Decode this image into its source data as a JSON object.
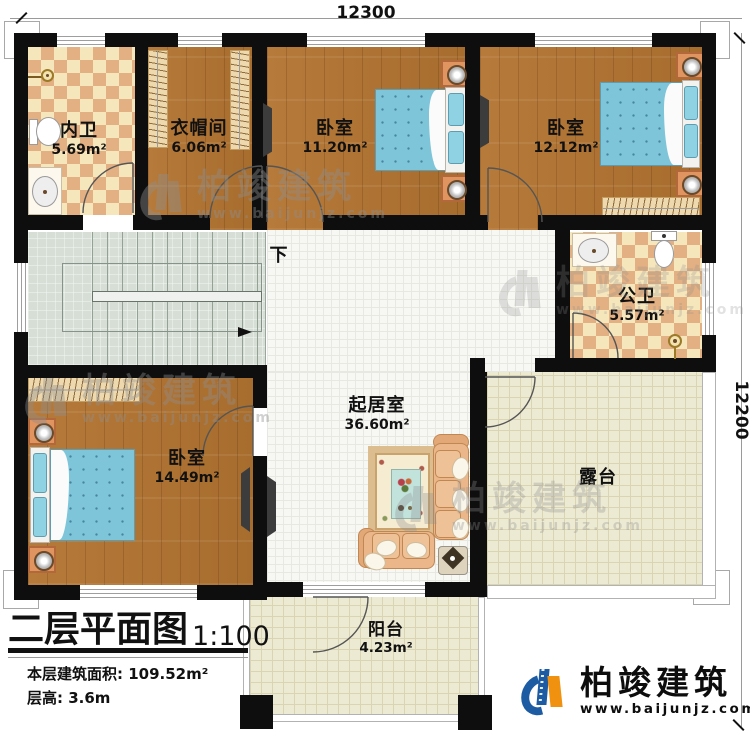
{
  "dimensions": {
    "top": "12300",
    "right": "12200"
  },
  "rooms": {
    "inner_bath": {
      "name": "内卫",
      "area": "5.69m²"
    },
    "cloakroom": {
      "name": "衣帽间",
      "area": "6.06m²"
    },
    "bedroom_top": {
      "name": "卧室",
      "area": "11.20m²"
    },
    "bedroom_right": {
      "name": "卧室",
      "area": "12.12m²"
    },
    "public_bath": {
      "name": "公卫",
      "area": "5.57m²"
    },
    "bedroom_left": {
      "name": "卧室",
      "area": "14.49m²"
    },
    "living": {
      "name": "起居室",
      "area": "36.60m²"
    },
    "terrace": {
      "name": "露台"
    },
    "balcony": {
      "name": "阳台",
      "area": "4.23m²"
    },
    "stair": {
      "down_label": "下"
    }
  },
  "title_block": {
    "title": "二层平面图",
    "scale": "1:100",
    "area_line": "本层建筑面积: 109.52m²",
    "floor_height_line": "层高: 3.6m"
  },
  "brand": {
    "name": "柏竣建筑",
    "url": "www.baijunjz.com"
  },
  "watermark": {
    "name": "柏竣建筑",
    "url": "www.baijunjz.com"
  }
}
